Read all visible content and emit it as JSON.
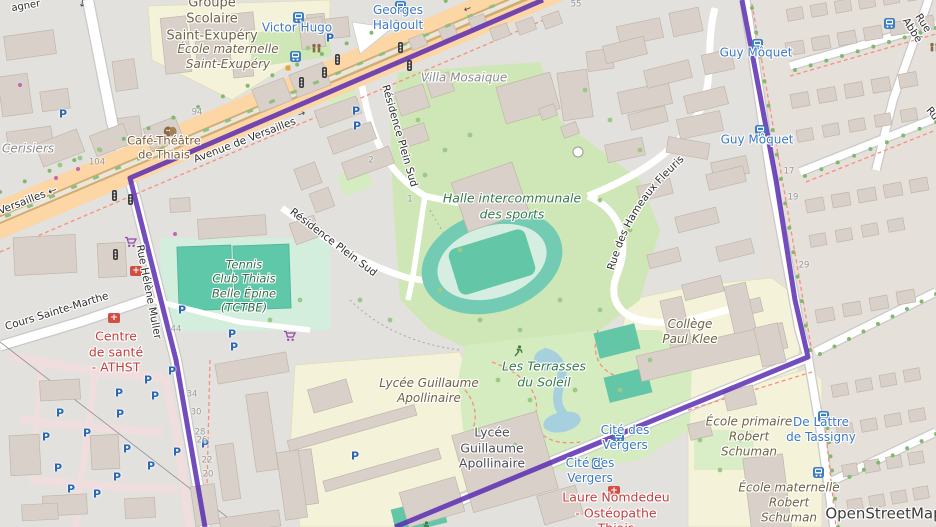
{
  "labels": {
    "agner": "agner",
    "groupe_scolaire": "Groupe\nScolaire\nSaint-Exupéry",
    "ecole_mat_exupery": "École maternelle\nSaint-Exupéry",
    "victor_hugo": "Victor Hugo",
    "georges_halgoult": "Georges\nHalgoult",
    "cafe_theatre": "Café-Théâtre\nde Thiais",
    "villa_mosaique": "Villa Mosaique",
    "avenue_versailles": "Avenue de Versailles",
    "versailles_w": "Versailles ←",
    "res_plein_sud": "Résidence Plein Sud",
    "rue_helene": "Rue Hélène Muller",
    "cours_ste_marthe": "Cours Sainte-Marthe",
    "halle_sports": "Halle intercommunale\ndes sports",
    "hameaux_fleuris": "Rue des Hameaux Fleuris",
    "rue_abbe": "Rue Abbé",
    "rue_partial": "Ru",
    "guy_moquet": "Guy Môquet",
    "tennis_club": "Tennis\nClub Thiais\nBelle Épine\n(TCTBE)",
    "centre_sante": "Centre\nde santé\n- ATHST",
    "s_cerisiers": "s Cerisiers",
    "college_klee": "Collège\nPaul Klee",
    "lycee_grounds": "Lycée Guillaume\nApollinaire",
    "lycee_building": "Lycée\nGuillaume\nApollinaire",
    "terrasses": "Les Terrasses\ndu Soleil",
    "cite_vergers": "Cité des\nVergers",
    "de_lattre": "De Lattre\nde Tassigny",
    "ecole_prim_schuman": "École primaire\nRobert\nSchuman",
    "ecole_mat_schuman": "École maternelle\nRobert\nSchuman",
    "laure": "Laure Nomdedeu\n- Ostéopathe\nThiais",
    "attribution": "OpenStreetMap"
  },
  "nums": {
    "n104": "104",
    "n94": "94",
    "n55": "55",
    "n2": "2",
    "n1": "1",
    "n17": "17",
    "n19": "19",
    "n29": "29",
    "n44": "44",
    "n34": "34",
    "n30": "30",
    "n28": "28",
    "n26": "26",
    "n22": "22",
    "n20": "20"
  },
  "icons": {
    "parking": "P",
    "medical": "+",
    "arrow_left": "←",
    "arrow_right": "→",
    "arrow_down": "↓"
  },
  "colors": {
    "boundary": "#5a2db2",
    "road_primary": "#fcd6a4",
    "water": "#a6d0dd",
    "transit_blue": "#3b79c2",
    "poi_red": "#c23e3e",
    "pitch_teal": "#63c6a7",
    "grass": "#cfe7b6"
  }
}
